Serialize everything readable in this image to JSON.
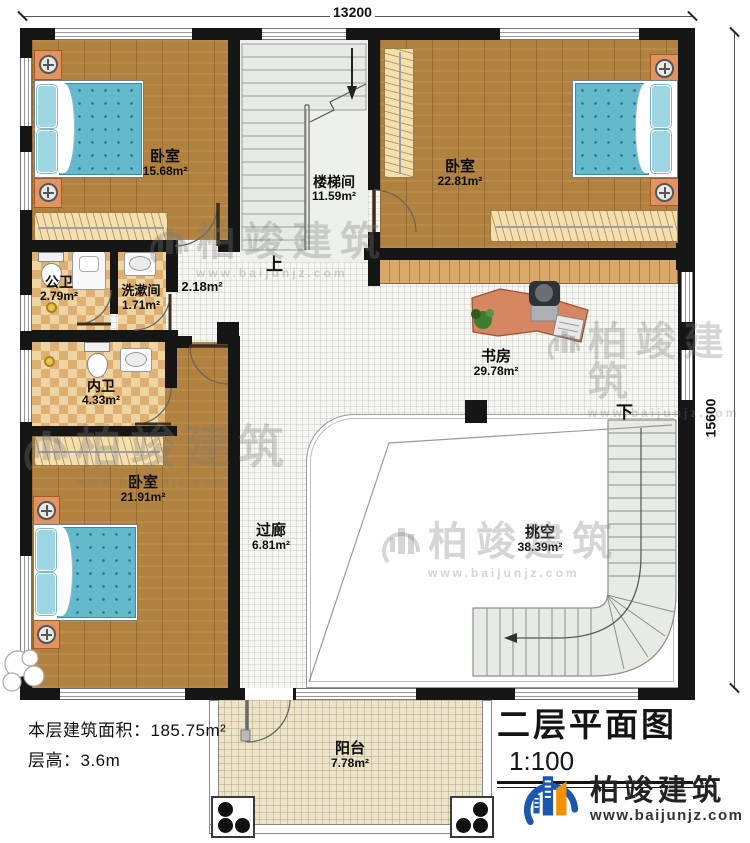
{
  "dimensions": {
    "width_mm": "13200",
    "height_mm": "15600"
  },
  "rooms": {
    "bedroom_top_left": {
      "name": "卧室",
      "area": "15.68m²"
    },
    "stairwell": {
      "name": "楼梯间",
      "area": "11.59m²"
    },
    "bedroom_top_right": {
      "name": "卧室",
      "area": "22.81m²"
    },
    "public_bath": {
      "name": "公卫",
      "area": "2.79m²"
    },
    "wash_room": {
      "name": "洗漱间",
      "area": "1.71m²"
    },
    "hallway": {
      "area": "2.18m²"
    },
    "inner_bath": {
      "name": "内卫",
      "area": "4.33m²"
    },
    "bedroom_bottom_left": {
      "name": "卧室",
      "area": "21.91m²"
    },
    "study": {
      "name": "书房",
      "area": "29.78m²"
    },
    "corridor": {
      "name": "过廊",
      "area": "6.81m²"
    },
    "void": {
      "name": "挑空",
      "area": "38.39m²"
    },
    "balcony": {
      "name": "阳台",
      "area": "7.78m²"
    }
  },
  "stairs": {
    "up": "上",
    "down": "下"
  },
  "info": {
    "floor_area_label": "本层建筑面积：",
    "floor_area_value": "185.75m²",
    "floor_height_label": "层高：",
    "floor_height_value": "3.6m"
  },
  "title": {
    "text": "二层平面图",
    "scale": "1:100"
  },
  "logo": {
    "company": "柏竣建筑",
    "website": "www.baijunjz.com"
  },
  "watermark": {
    "company": "柏竣建筑",
    "website": "www.baijunjz.com"
  },
  "colors": {
    "wall": "#161616",
    "wood_floor": "#b0813f",
    "bath_tile": "#e8c28a",
    "mattress_blue": "#64b9cd",
    "stair_tread": "#e6ebe3",
    "balcony_tile": "#ebe3ca",
    "logo_blue": "#1b57ad",
    "logo_orange": "#f29200"
  }
}
